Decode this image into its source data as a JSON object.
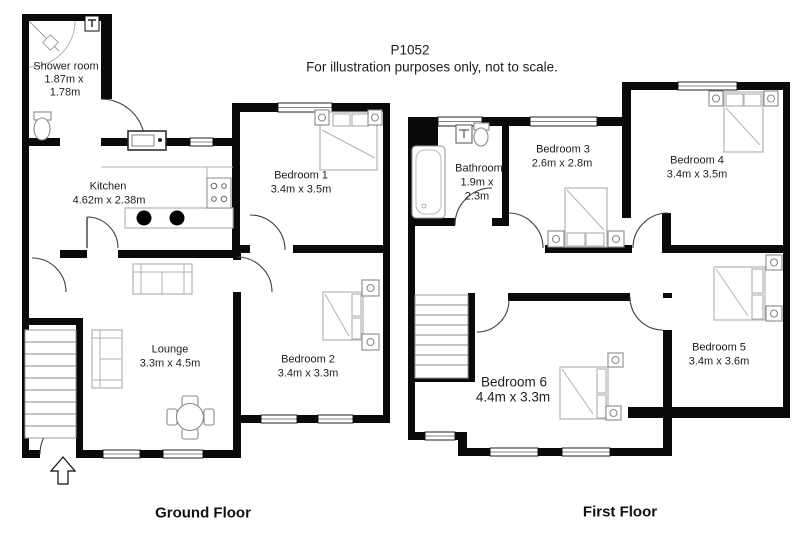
{
  "title": {
    "plan_id": "P1052",
    "disclaimer": "For illustration purposes only, not to scale."
  },
  "colors": {
    "background": "#ffffff",
    "wall": "#0a0a0a",
    "furniture_outline": "#b3b3b3",
    "text": "#1d1d1d"
  },
  "ground_floor": {
    "label": "Ground Floor",
    "rooms": {
      "shower_room": {
        "name": "Shower room",
        "dim1": "1.87m x",
        "dim2": "1.78m"
      },
      "kitchen": {
        "name": "Kitchen",
        "dims": "4.62m x 2.38m"
      },
      "bedroom1": {
        "name": "Bedroom 1",
        "dims": "3.4m x 3.5m"
      },
      "lounge": {
        "name": "Lounge",
        "dims": "3.3m x 4.5m"
      },
      "bedroom2": {
        "name": "Bedroom 2",
        "dims": "3.4m x 3.3m"
      }
    },
    "fixtures": [
      "shower-enclosure",
      "toilet",
      "radiator",
      "sink",
      "hob",
      "counter",
      "sofa",
      "sofa",
      "dining-table",
      "chairs",
      "stairs",
      "entrance-arrow",
      "double-bed",
      "double-bed"
    ]
  },
  "first_floor": {
    "label": "First Floor",
    "rooms": {
      "bathroom": {
        "name": "Bathroom",
        "dim1": "1.9m x",
        "dim2": "2.3m"
      },
      "bedroom3": {
        "name": "Bedroom 3",
        "dims": "2.6m x 2.8m"
      },
      "bedroom4": {
        "name": "Bedroom 4",
        "dims": "3.4m x 3.5m"
      },
      "bedroom5": {
        "name": "Bedroom 5",
        "dims": "3.4m x 3.6m"
      },
      "bedroom6": {
        "name": "Bedroom 6",
        "dims": "4.4m x 3.3m"
      }
    },
    "fixtures": [
      "bathtub",
      "basin",
      "toilet",
      "stairs",
      "double-bed",
      "double-bed",
      "double-bed",
      "double-bed"
    ]
  }
}
